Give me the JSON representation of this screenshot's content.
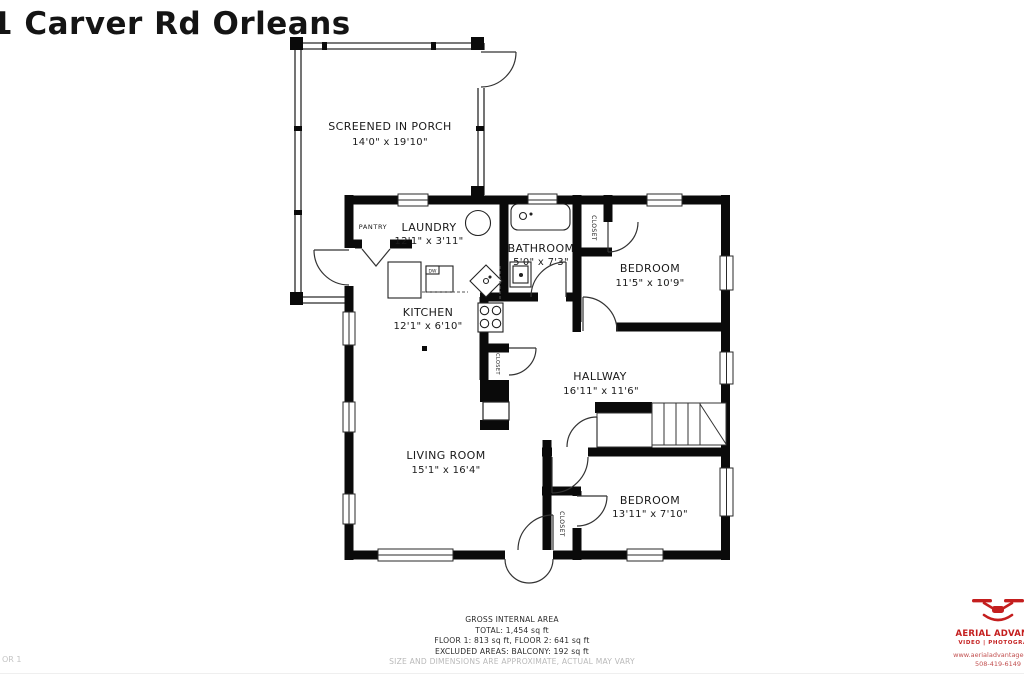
{
  "title": "1 Carver Rd Orleans",
  "floor_page_label": "OR 1",
  "plan": {
    "porch": {
      "name": "SCREENED IN PORCH",
      "dims": "14'0\" x 19'10\""
    },
    "pantry": {
      "name": "PANTRY"
    },
    "laundry": {
      "name": "LAUNDRY",
      "dims": "12'1\" x 3'11\""
    },
    "bathroom": {
      "name": "BATHROOM",
      "dims": "5'0\" x 7'3\""
    },
    "bedroom1": {
      "name": "BEDROOM",
      "dims": "11'5\" x 10'9\""
    },
    "kitchen": {
      "name": "KITCHEN",
      "dims": "12'1\" x 6'10\""
    },
    "hallway": {
      "name": "HALLWAY",
      "dims": "16'11\" x 11'6\""
    },
    "living_room": {
      "name": "LIVING ROOM",
      "dims": "15'1\" x 16'4\""
    },
    "bedroom2": {
      "name": "BEDROOM",
      "dims": "13'11\" x 7'10\""
    },
    "closet_label": "CLOSET",
    "dishwasher_label": "DW"
  },
  "footer": {
    "heading": "GROSS INTERNAL AREA",
    "total": "TOTAL: 1,454 sq ft",
    "floors": "FLOOR 1: 813 sq ft, FLOOR 2: 641 sq ft",
    "excluded": "EXCLUDED AREAS: BALCONY: 192 sq ft",
    "disclaimer": "SIZE AND DIMENSIONS ARE APPROXIMATE, ACTUAL MAY VARY"
  },
  "logo": {
    "company": "AERIAL ADVANTA",
    "tagline": "VIDEO | PHOTOGRAPH",
    "website": "www.aerialadvantagecapec",
    "phone": "508-419-6149"
  },
  "colors": {
    "wall": "#0a0a0a",
    "accent_red": "#c41e1e",
    "muted_gray": "#bbbbbb"
  }
}
